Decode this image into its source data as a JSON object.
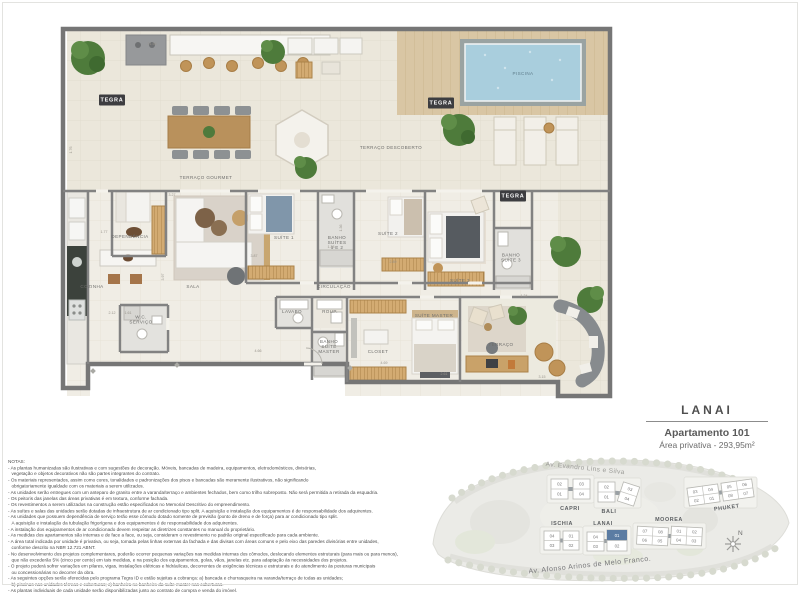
{
  "brand": "TEGRA",
  "header": {
    "title": "LANAI",
    "subtitle": "Apartamento 101",
    "area": "Área privativa - 293,95m²"
  },
  "floor_plan": {
    "rooms": [
      {
        "label": "TERRAÇO GOURMET",
        "x": 206,
        "y": 178
      },
      {
        "label": "TERRAÇO DESCOBERTO",
        "x": 391,
        "y": 148
      },
      {
        "label": "PISCINA",
        "x": 523,
        "y": 74,
        "color": "#5e7d8b"
      },
      {
        "label": "DEPENDÊNCIA",
        "x": 130,
        "y": 237
      },
      {
        "label": "COZINHA",
        "x": 92,
        "y": 287
      },
      {
        "label": "SALA",
        "x": 193,
        "y": 287
      },
      {
        "label": "SUÍTE 1",
        "x": 284,
        "y": 238
      },
      {
        "lines": [
          "BANHO",
          "SUÍTES",
          "1 E 2"
        ],
        "x": 337,
        "y": 243
      },
      {
        "label": "SUÍTE 2",
        "x": 388,
        "y": 234
      },
      {
        "label": "CIRCULAÇÃO",
        "x": 334,
        "y": 287
      },
      {
        "label": "SUÍTE 3",
        "x": 460,
        "y": 281
      },
      {
        "lines": [
          "BANHO",
          "SUÍTE 3"
        ],
        "x": 511,
        "y": 258
      },
      {
        "lines": [
          "W.C.",
          "SERVIÇO"
        ],
        "x": 141,
        "y": 320
      },
      {
        "label": "LAVABO",
        "x": 292,
        "y": 312
      },
      {
        "label": "ROUP.",
        "x": 330,
        "y": 312
      },
      {
        "lines": [
          "BANHO",
          "SUÍTE",
          "MASTER"
        ],
        "x": 329,
        "y": 347
      },
      {
        "label": "CLOSET",
        "x": 378,
        "y": 352
      },
      {
        "label": "SUÍTE MASTER",
        "x": 434,
        "y": 316
      },
      {
        "label": "TERRAÇO",
        "x": 501,
        "y": 345
      }
    ],
    "tegra_marks": [
      {
        "x": 112,
        "y": 100
      },
      {
        "x": 441,
        "y": 103
      },
      {
        "x": 513,
        "y": 196
      }
    ],
    "dimensions": [
      {
        "t": "21.56",
        "x": 152,
        "y": 44,
        "r": 0
      },
      {
        "t": "1.76",
        "x": 71,
        "y": 150,
        "r": -90
      },
      {
        "t": "1.77",
        "x": 104,
        "y": 232,
        "r": 0
      },
      {
        "t": "3.27",
        "x": 172,
        "y": 195,
        "r": 0
      },
      {
        "t": "3.87",
        "x": 254,
        "y": 256,
        "r": 0
      },
      {
        "t": "3.97",
        "x": 163,
        "y": 277,
        "r": -90
      },
      {
        "t": "2.89",
        "x": 393,
        "y": 262,
        "r": 0
      },
      {
        "t": "1.36",
        "x": 341,
        "y": 228,
        "r": -90
      },
      {
        "t": "1.28",
        "x": 331,
        "y": 247,
        "r": 0
      },
      {
        "t": "2.12",
        "x": 112,
        "y": 313,
        "r": 0
      },
      {
        "t": "1.61",
        "x": 128,
        "y": 313,
        "r": 0
      },
      {
        "t": "4.66",
        "x": 258,
        "y": 351,
        "r": 0
      },
      {
        "t": "4.69",
        "x": 384,
        "y": 363,
        "r": 0
      },
      {
        "t": "2.61",
        "x": 444,
        "y": 374,
        "r": 0
      },
      {
        "t": "1.34",
        "x": 524,
        "y": 296,
        "r": 0
      },
      {
        "t": "3.15",
        "x": 542,
        "y": 377,
        "r": 0
      }
    ]
  },
  "notes": {
    "title": "NOTAS:",
    "lines": [
      "- As plantas humanizadas são ilustrativas e com sugestões de decoração. Móveis, bancadas de madeira, equipamentos, eletrodomésticos, divisórias,",
      "vegetação e objetos decorativos não são partes integrantes do contrato.",
      "- Os materiais representados, assim como cores, tonalidades e padronizações dos pisos e bancadas são meramente ilustrativos, não significando",
      "obrigatoriamente igualdade com os materiais a serem utilizados.",
      "- As unidades serão entregues com um anteparo de granito entre a varanda/terraço e ambientes fechados, bem como trilho sobreposto. Não será permitida a retirada da esquadria.",
      "- Os peitoris das janelas das áreas privativas é em textura, conforme fachada.",
      "- Os revestimentos a serem utilizados na construção estão especificados no Memorial Descritivo do empreendimento.",
      "- As suítes e salas das unidades serão dotadas de infraestrutura de ar condicionado tipo split. A aquisição e instalação dos equipamentos é de responsabilidade dos adquirentes.",
      "- As unidades que possuem dependência de serviço terão esse cômodo dotado somente de previsão (ponto de dreno e de força) para ar condicionado tipo split.",
      "A aquisição e instalação da tubulação frigorígena e dos equipamentos é de responsabilidade dos adquirentes.",
      "- A instalação dos equipamentos de ar condicionado devem respeitar as diretrizes constantes no manual do proprietário.",
      "- As medidas dos apartamentos são internas e de face a face, ou seja, consideram o revestimento no padrão original especificado para cada ambiente.",
      "- A área total indicada por unidade é privativa, ou seja, tomada pelas linhas externas da fachada e das divisas com áreas comuns e pelo eixo das paredes divisórias entre unidades,",
      "conforme descrito na NBR 12.721 ABNT.",
      "- No desenvolvimento dos projetos complementares, poderão ocorrer pequenas variações nas medidas internas dos cômodos, deslocando elementos estruturais (para mais ou para menos),",
      "que não excederão 5% (cinco por cento) em tais medidas, e na posição dos equipamentos, golas, vãos, janelas etc. para adaptação às necessidades dos projetos.",
      "- O projeto poderá sofrer variações em pilares, vigas, instalações elétricas e hidráulicas, decorrentes de exigências técnicas e estruturais e do atendimento às posturas municipais",
      "ou concessionárias no decorrer da obra.",
      "- As seguintes opções serão oferecidas pelo programa Tegra ID e estão sujeitas a cobrança: a) bancada e churrasqueira na varanda/terraço de todas as unidades;",
      "b) piscinas nas unidades térreas e coberturas; c) banheira no banheiro da suíte master nas coberturas.",
      "- As plantas individuais de cada unidade serão disponibilizadas junto ao contrato de compra e venda do imóvel."
    ]
  },
  "site_plan": {
    "streets": {
      "top": "Av. Evandro Lins e Silva",
      "bottom": "Av. Afonso Arinos de Melo Franco."
    },
    "north_label": "N",
    "highlight_color": "#5b7ca3",
    "buildings": [
      {
        "name": "CAPRI",
        "label": {
          "x": 570,
          "y": 510
        },
        "slabs": [
          {
            "x": 551,
            "y": 479,
            "w": 17,
            "h": 20,
            "rot": 0,
            "top": [
              "02"
            ],
            "bottom": [
              "01"
            ]
          },
          {
            "x": 573,
            "y": 479,
            "w": 17,
            "h": 20,
            "rot": 0,
            "top": [
              "03"
            ],
            "bottom": [
              "04"
            ]
          }
        ]
      },
      {
        "name": "BALI",
        "label": {
          "x": 609,
          "y": 513
        },
        "slabs": [
          {
            "x": 598,
            "y": 482,
            "w": 17,
            "h": 20,
            "rot": 0,
            "top": [
              "02"
            ],
            "bottom": [
              "01"
            ]
          },
          {
            "x": 620,
            "y": 484,
            "w": 17,
            "h": 20,
            "rot": 18,
            "top": [
              "03"
            ],
            "bottom": [
              "04"
            ]
          }
        ]
      },
      {
        "name": "PHUKET",
        "label": {
          "x": 727,
          "y": 509,
          "rot": -8
        },
        "slabs": [
          {
            "x": 688,
            "y": 486,
            "w": 31,
            "h": 18,
            "rot": -8,
            "top": [
              "03",
              "04"
            ],
            "bottom": [
              "02",
              "01"
            ]
          },
          {
            "x": 722,
            "y": 481,
            "w": 31,
            "h": 18,
            "rot": -8,
            "top": [
              "05",
              "06"
            ],
            "bottom": [
              "08",
              "07"
            ]
          }
        ]
      },
      {
        "name": "ISCHIA",
        "label": {
          "x": 562,
          "y": 525
        },
        "slabs": [
          {
            "x": 544,
            "y": 531,
            "w": 16,
            "h": 19,
            "rot": 0,
            "top": [
              "04"
            ],
            "bottom": [
              "03"
            ]
          },
          {
            "x": 563,
            "y": 531,
            "w": 16,
            "h": 19,
            "rot": 0,
            "top": [
              "01"
            ],
            "bottom": [
              "02"
            ]
          }
        ]
      },
      {
        "name": "LANAI",
        "label": {
          "x": 603,
          "y": 525
        },
        "slabs": [
          {
            "x": 587,
            "y": 532,
            "w": 17,
            "h": 19,
            "rot": 0,
            "top": [
              "04"
            ],
            "bottom": [
              "03"
            ]
          },
          {
            "x": 607,
            "y": 530,
            "w": 20,
            "h": 21,
            "rot": 0,
            "top": [
              "01"
            ],
            "bottom": [
              "02"
            ],
            "highlight": "01"
          }
        ]
      },
      {
        "name": "MOOREA",
        "label": {
          "x": 669,
          "y": 521
        },
        "slabs": [
          {
            "x": 637,
            "y": 527,
            "w": 31,
            "h": 18,
            "rot": 3,
            "top": [
              "07",
              "08"
            ],
            "bottom": [
              "06",
              "05"
            ]
          },
          {
            "x": 671,
            "y": 527,
            "w": 31,
            "h": 18,
            "rot": 3,
            "top": [
              "01",
              "02"
            ],
            "bottom": [
              "04",
              "03"
            ]
          }
        ]
      }
    ]
  }
}
